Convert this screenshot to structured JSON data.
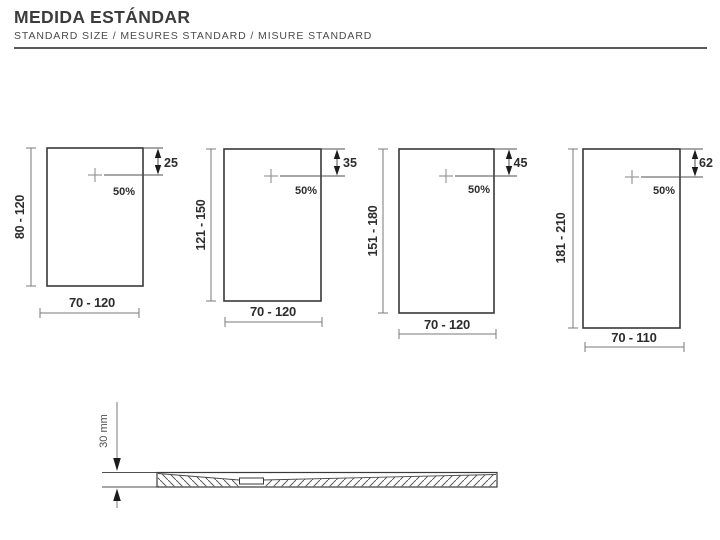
{
  "header": {
    "title": "MEDIDA ESTÁNDAR",
    "subtitle": "STANDARD SIZE / MESURES STANDARD / MISURE STANDARD"
  },
  "trays": [
    {
      "height_range": "80 - 120",
      "width_range": "70 - 120",
      "drain_offset": "25",
      "drain_position": "50%"
    },
    {
      "height_range": "121 - 150",
      "width_range": "70 - 120",
      "drain_offset": "35",
      "drain_position": "50%"
    },
    {
      "height_range": "151 - 180",
      "width_range": "70 - 120",
      "drain_offset": "45",
      "drain_position": "50%"
    },
    {
      "height_range": "181 - 210",
      "width_range": "70 - 110",
      "drain_offset": "62",
      "drain_position": "50%"
    }
  ],
  "section": {
    "thickness_label": "30 mm"
  },
  "colors": {
    "line": "#383838",
    "dim_line": "#7a7a7a",
    "text": "#2d2d2d",
    "cross": "#919191",
    "background": "#ffffff"
  }
}
